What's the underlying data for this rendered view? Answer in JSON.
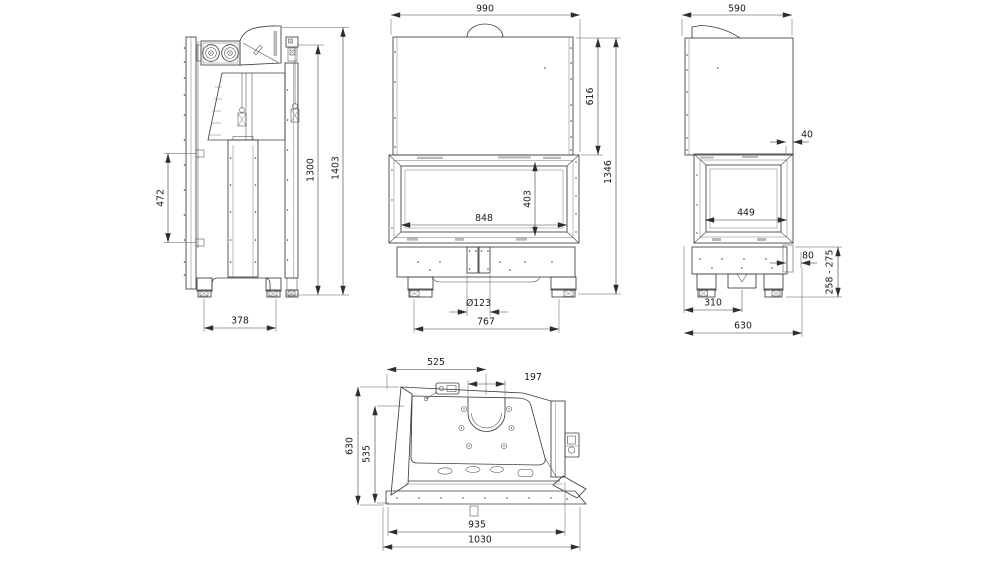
{
  "title": "Fireplace insert technical drawing - four orthographic views",
  "colors": {
    "background": "#ffffff",
    "line": "#3d3d3d",
    "dimension_text": "#191919"
  },
  "dims": {
    "side": {
      "d472": "472",
      "d1300": "1300",
      "d1403": "1403",
      "d378": "378"
    },
    "front": {
      "d990": "990",
      "d616": "616",
      "d1346": "1346",
      "d848": "848",
      "d403": "403",
      "d123": "Ø123",
      "d767": "767"
    },
    "right": {
      "d590": "590",
      "d40": "40",
      "d449": "449",
      "d80": "80",
      "d258_275": "258 - 275",
      "d310": "310",
      "d630": "630"
    },
    "top": {
      "d525": "525",
      "d197": "197",
      "d630": "630",
      "d535": "535",
      "d935": "935",
      "d1030": "1030"
    }
  }
}
